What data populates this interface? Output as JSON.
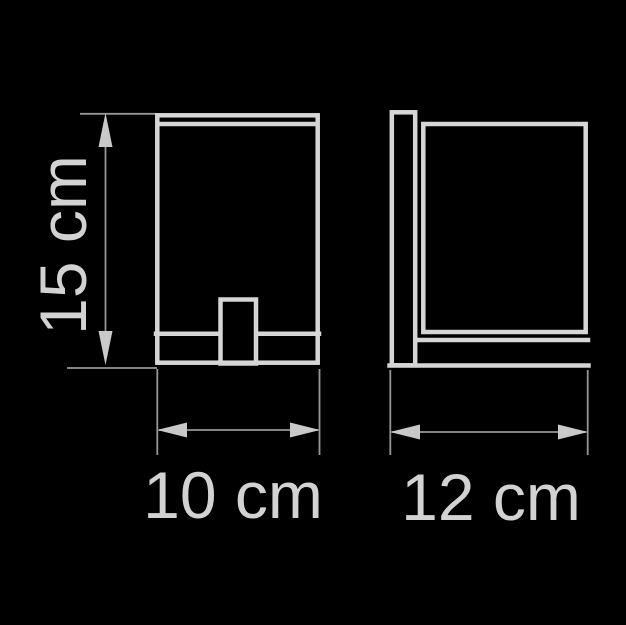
{
  "colors": {
    "background": "#000000",
    "outline": "#d6d6d6",
    "thin_line": "#969696",
    "arrow": "#c9c9c9",
    "label": "#d2d2d2"
  },
  "dimensions": {
    "height": {
      "label": "15 cm",
      "value": 15,
      "unit": "cm"
    },
    "width": {
      "label": "10 cm",
      "value": 10,
      "unit": "cm"
    },
    "depth": {
      "label": "12 cm",
      "value": 12,
      "unit": "cm"
    }
  }
}
